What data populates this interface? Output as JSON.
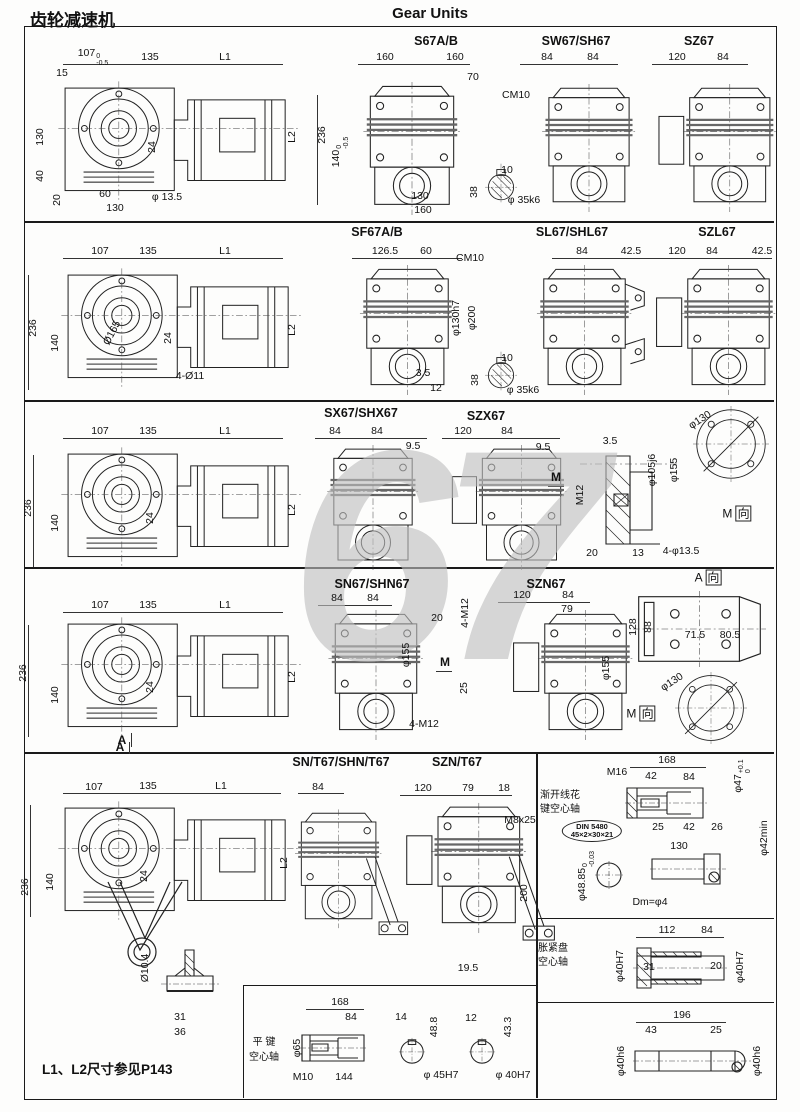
{
  "page": {
    "title_cn": "齿轮减速机",
    "title_en": "Gear Units",
    "note": "L1、L2尺寸参见P143",
    "watermark": "67"
  },
  "row1": {
    "gm": {
      "d107": "107",
      "tol_up": "0",
      "tol_dn": "-0.5",
      "d135": "135",
      "L1": "L1",
      "d15": "15",
      "d130": "130",
      "d40": "40",
      "d20": "20",
      "d60": "60",
      "d130b": "130",
      "hole": "φ 13.5",
      "d24": "24",
      "L2": "L2"
    },
    "s67": {
      "title": "S67A/B",
      "d160l": "160",
      "d160r": "160",
      "d70": "70",
      "thread": "CM10",
      "d236": "236",
      "d140": "140",
      "tol_up": "0",
      "tol_dn": "-0.5",
      "d130": "130",
      "d160": "160"
    },
    "shaft": {
      "d10": "10",
      "d38": "38",
      "dia": "φ 35k6"
    },
    "sw67": {
      "title": "SW67/SH67",
      "d84l": "84",
      "d84r": "84"
    },
    "sz67": {
      "title": "SZ67",
      "d120": "120",
      "d84": "84"
    }
  },
  "row2": {
    "gm": {
      "d107": "107",
      "d135": "135",
      "L1": "L1",
      "d236": "236",
      "d140": "140",
      "flange": "Ø165",
      "d24": "24",
      "holes": "4-Ø11",
      "L2": "L2"
    },
    "sf67": {
      "title": "SF67A/B",
      "d126": "126.5",
      "d60": "60",
      "thread": "CM10",
      "spigot": "φ130h7",
      "flange": "φ200",
      "d35": "3.5",
      "d12": "12"
    },
    "shaft": {
      "d10": "10",
      "d38": "38",
      "dia": "φ 35k6"
    },
    "sl67": {
      "title": "SL67/SHL67",
      "d84": "84",
      "d425": "42.5"
    },
    "szl67": {
      "title": "SZL67",
      "d120": "120",
      "d84": "84",
      "d425": "42.5"
    }
  },
  "row3": {
    "gm": {
      "d107": "107",
      "d135": "135",
      "L1": "L1",
      "d236": "236",
      "d140": "140",
      "d24": "24",
      "L2": "L2"
    },
    "sx67": {
      "title": "SX67/SHX67",
      "d84l": "84",
      "d84r": "84",
      "d95": "9.5"
    },
    "szx67": {
      "title": "SZX67",
      "d120": "120",
      "d84": "84",
      "d95": "9.5",
      "view": "M"
    },
    "section": {
      "d35": "3.5",
      "thread": "M12",
      "bore": "φ105j6",
      "flange": "φ155",
      "d20": "20",
      "d13": "13",
      "holes": "4-φ13.5"
    },
    "mview": {
      "bolt_circle": "φ130",
      "letter": "M",
      "dir": "向"
    }
  },
  "row4": {
    "gm": {
      "d107": "107",
      "d135": "135",
      "L1": "L1",
      "d236": "236",
      "d140": "140",
      "d24": "24",
      "L2": "L2",
      "view": "A"
    },
    "sn67": {
      "title": "SN67/SHN67",
      "d84l": "84",
      "d84r": "84",
      "d20": "20",
      "studs_top": "4-M12",
      "flange": "φ155",
      "view": "M",
      "d25": "25",
      "studs_bot": "4-M12"
    },
    "szn67": {
      "title": "SZN67",
      "d120": "120",
      "d84": "84",
      "d79": "79",
      "flange": "φ155"
    },
    "aview": {
      "letter": "A",
      "dir": "向",
      "d128": "128",
      "d88": "88",
      "d715": "71.5",
      "d805": "80.5"
    },
    "mview": {
      "bolt_circle": "φ130",
      "letter": "M",
      "dir": "向"
    }
  },
  "row5": {
    "gm": {
      "view": "A",
      "d107": "107",
      "d135": "135",
      "L1": "L1",
      "d236": "236",
      "d140": "140",
      "d24": "24",
      "L2": "L2",
      "pin": "Ø10.4",
      "d31": "31",
      "d36": "36"
    },
    "snt67": {
      "title": "SN/T67/SHN/T67",
      "d84": "84"
    },
    "sznt67": {
      "title": "SZN/T67",
      "d120": "120",
      "d79": "79",
      "d18": "18",
      "bolt": "M8x25",
      "d200": "200",
      "d195": "19.5"
    },
    "spline": {
      "label1": "渐开线花",
      "label2": "键空心轴",
      "d168": "168",
      "thread": "M16",
      "d42a": "42",
      "d84": "84",
      "bore": "φ47",
      "tol_up": "+0.1",
      "tol_dn": "0",
      "d25": "25",
      "d42b": "42",
      "d26": "26",
      "din1": "DIN 5480",
      "din2": "45×2×30×21",
      "d130": "130",
      "min": "φ42min",
      "dia4885": "φ48.85",
      "tol2_up": "0",
      "tol2_dn": "-0.03",
      "dm": "Dm=φ4"
    },
    "shrink": {
      "label1": "胀紧盘",
      "label2": "空心轴",
      "d112": "112",
      "d84": "84",
      "boreL": "φ40H7",
      "d31": "31",
      "d20": "20",
      "boreR": "φ40H7"
    },
    "solid": {
      "d196": "196",
      "d43": "43",
      "d25": "25",
      "diaL": "φ40h6",
      "diaR": "φ40h6"
    },
    "key": {
      "label1": "平 键",
      "label2": "空心轴",
      "d168": "168",
      "d84": "84",
      "dia65": "φ65",
      "thread": "M10",
      "d144": "144",
      "s1_w": "14",
      "s1_h": "48.8",
      "s1_bore": "φ 45H7",
      "s2_w": "12",
      "s2_h": "43.3",
      "s2_bore": "φ 40H7"
    }
  }
}
